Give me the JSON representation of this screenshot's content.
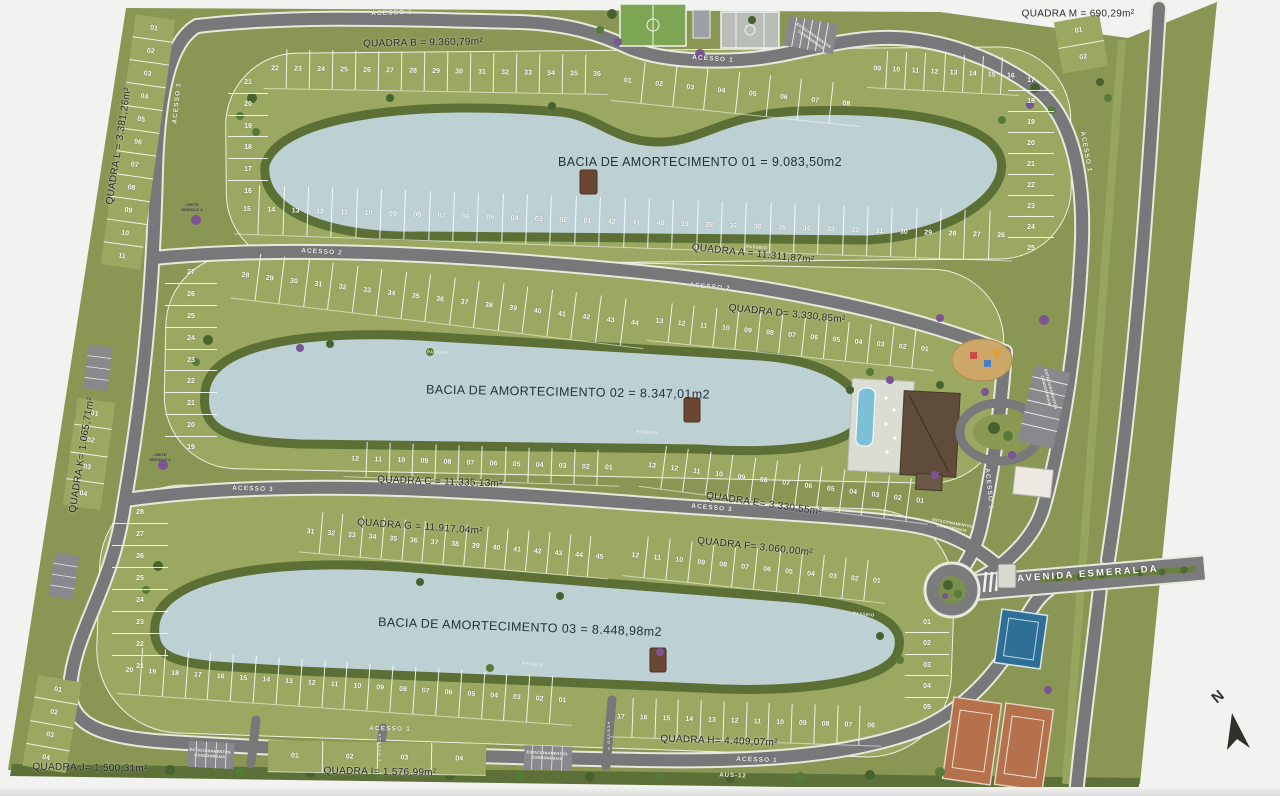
{
  "map": {
    "north_label": "N",
    "colors": {
      "site_green": "#8a9754",
      "lot_green": "#9aa861",
      "bank_green": "#5c7036",
      "water_blue": "#bdd0d3",
      "road_gray": "#76787a",
      "court_clay": "#b5714b",
      "court_blue": "#2f6e96",
      "roof_brown": "#5f4c3a"
    },
    "quadras": {
      "A": "QUADRA A = 11.311,87m²",
      "B": "QUADRA B = 9.360,79m²",
      "C": "QUADRA C = 11.335,13m²",
      "D": "QUADRA D= 3.330,85m²",
      "E": "QUADRA E= 3.330,55m²",
      "F": "QUADRA F= 3.060,00m²",
      "G": "QUADRA G = 11.917,04m²",
      "H": "QUADRA H= 4.409,07m²",
      "I": "QUADRA I= 1.576,99m²",
      "J": "QUADRA J= 1.500,31m²",
      "K": "QUADRA K= 1.065,71m²",
      "L": "QUADRA L = 3.381,26m²",
      "M": "QUADRA M = 690,29m²"
    },
    "basins": {
      "b1": "BACIA DE AMORTECIMENTO 01 = 9.083,50m2",
      "b2": "BACIA DE AMORTECIMENTO 02 = 8.347,01m2",
      "b3": "BACIA DE AMORTECIMENTO 03 = 8.448,98m2"
    },
    "roads": {
      "acesso1": "ACESSO 1",
      "acesso2": "ACESSO 2",
      "acesso3": "ACESSO 3",
      "acesso4": "ACESSO 4",
      "acesso5": "ACESSO 5",
      "avenida": "AVENIDA ESMERALDA",
      "aus12": "AUS-12"
    },
    "misc": {
      "parking": "ESTACIONAMENTOS CONDOMINIAIS",
      "passeio": "PASSEIO",
      "limite": "LIMITE MÓDULO 2"
    },
    "lots": {
      "b_top": [
        "22",
        "23",
        "24",
        "25",
        "26",
        "27",
        "28",
        "29",
        "30",
        "31",
        "32",
        "33",
        "34",
        "35",
        "36"
      ],
      "a_top": [
        "01",
        "02",
        "03",
        "04",
        "05",
        "06",
        "07",
        "08"
      ],
      "a_top2": [
        "09",
        "10",
        "11",
        "12",
        "13",
        "14",
        "15",
        "16"
      ],
      "a_rfan": [
        "17",
        "18",
        "19",
        "20",
        "21",
        "22",
        "23",
        "24",
        "25"
      ],
      "a_bottom": [
        "15",
        "14",
        "13",
        "12",
        "11",
        "10",
        "09",
        "08",
        "07",
        "06",
        "05",
        "04",
        "03",
        "02",
        "01",
        "42",
        "41",
        "40",
        "39",
        "38",
        "37",
        "36",
        "35",
        "34",
        "33",
        "32",
        "31",
        "30",
        "29",
        "28",
        "27",
        "26"
      ],
      "b_fan": [
        "21",
        "20",
        "19",
        "18",
        "17",
        "16"
      ],
      "l_strip": [
        "01",
        "02",
        "03",
        "04",
        "05",
        "06",
        "07",
        "08",
        "09",
        "10",
        "11"
      ],
      "k_strip": [
        "01",
        "02",
        "03",
        "04"
      ],
      "c_top": [
        "28",
        "29",
        "30",
        "31",
        "32",
        "33",
        "34",
        "35",
        "36",
        "37",
        "38",
        "39",
        "40",
        "41",
        "42",
        "43",
        "44"
      ],
      "d_row": [
        "13",
        "12",
        "11",
        "10",
        "09",
        "08",
        "07",
        "06",
        "05",
        "04",
        "03",
        "02",
        "01"
      ],
      "m_fan": [
        "27",
        "26",
        "25",
        "24",
        "23",
        "22",
        "21",
        "20",
        "19"
      ],
      "c_bottom": [
        "12",
        "11",
        "10",
        "09",
        "08",
        "07",
        "06",
        "05",
        "04",
        "03",
        "02",
        "01"
      ],
      "e_row": [
        "13",
        "12",
        "11",
        "10",
        "09",
        "08",
        "07",
        "06",
        "05",
        "04",
        "03",
        "02",
        "01"
      ],
      "g_top": [
        "31",
        "32",
        "33",
        "34",
        "35",
        "36",
        "37",
        "38",
        "39",
        "40",
        "41",
        "42",
        "43",
        "44",
        "45"
      ],
      "f_row": [
        "12",
        "11",
        "10",
        "09",
        "08",
        "07",
        "06",
        "05",
        "04",
        "03",
        "02",
        "01"
      ],
      "b_fan2": [
        "28",
        "27",
        "26",
        "25",
        "24",
        "23",
        "22",
        "21"
      ],
      "g_bottom": [
        "20",
        "19",
        "18",
        "17",
        "16",
        "15",
        "14",
        "13",
        "12",
        "11",
        "10",
        "09",
        "08",
        "07",
        "06",
        "05",
        "04",
        "03",
        "02",
        "01"
      ],
      "h_row": [
        "17",
        "16",
        "15",
        "14",
        "13",
        "12",
        "11",
        "10",
        "09",
        "08",
        "07",
        "06"
      ],
      "h_fan": [
        "01",
        "02",
        "03",
        "04",
        "05"
      ],
      "j_strip": [
        "01",
        "02",
        "03",
        "04"
      ],
      "i_strip": [
        "01",
        "02",
        "03",
        "04"
      ],
      "m_strip": [
        "01",
        "02"
      ]
    }
  }
}
